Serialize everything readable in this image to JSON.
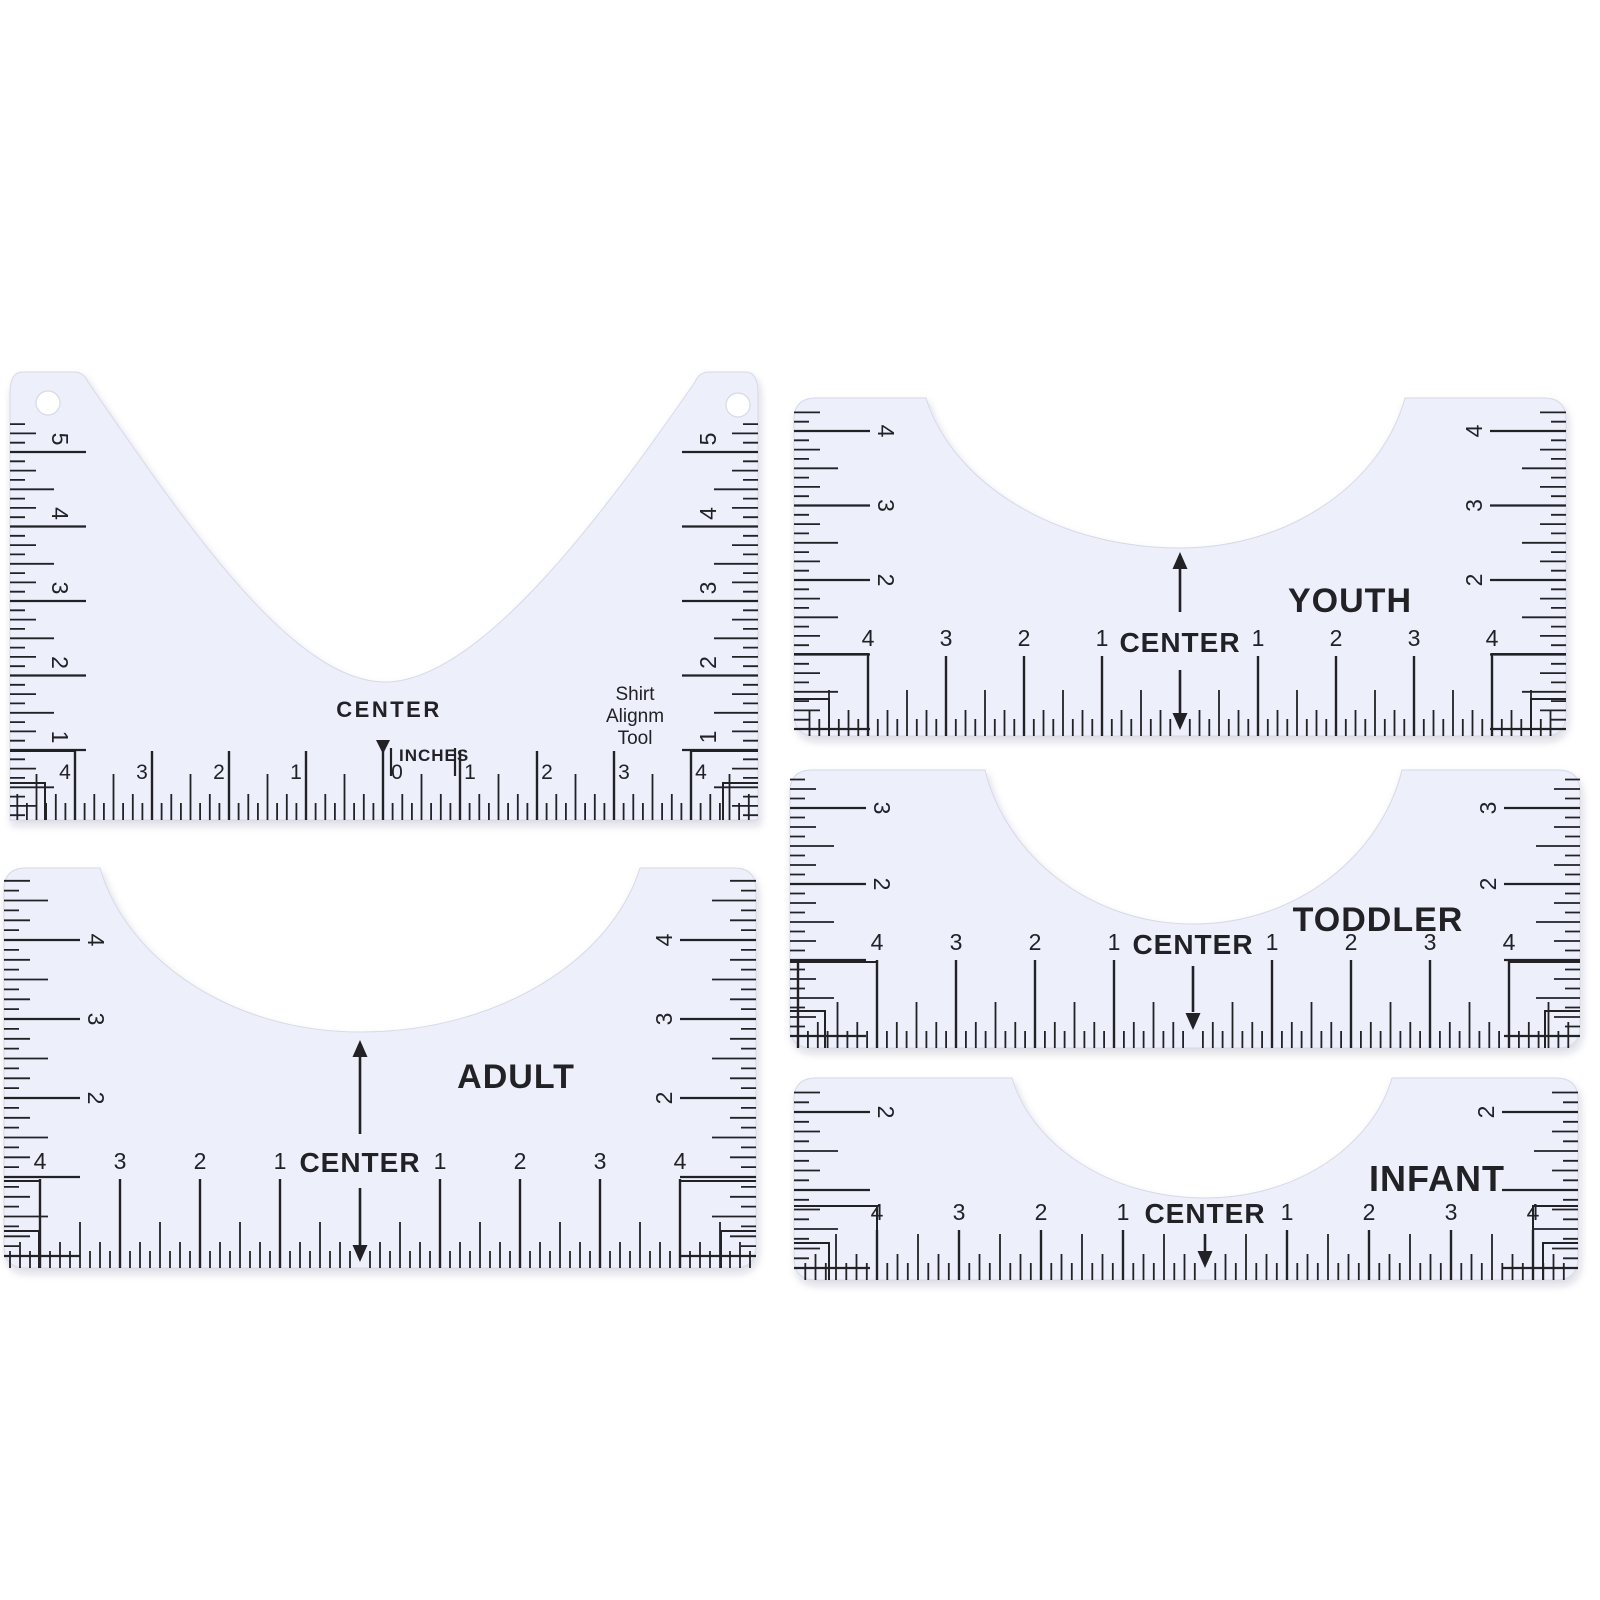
{
  "scene": {
    "width": 1600,
    "height": 1600,
    "background": "#ffffff",
    "ruler_fill": "#edeffa",
    "ruler_stroke": "#d6d9e8",
    "ink": "#212126",
    "muted_ink": "#34343a",
    "shadow_color": "#2e3252"
  },
  "rulers": [
    {
      "id": "alignment-tool",
      "texts": {
        "center": "CENTER",
        "units": "INCHES",
        "tool_lines": [
          "Shirt",
          "Alignm",
          "Tool"
        ]
      },
      "bottom": {
        "left": [
          "4",
          "3",
          "2",
          "1"
        ],
        "zero": "0",
        "right": [
          "1",
          "2",
          "3",
          "4"
        ]
      },
      "left_scale": [
        "5",
        "4",
        "3",
        "2",
        "1"
      ],
      "right_scale": [
        "5",
        "4",
        "3",
        "2",
        "1"
      ],
      "marker": "down-triangle",
      "geom": {
        "type": "big",
        "l": 10,
        "r": 758,
        "t": 372,
        "b": 820,
        "tabWL": 78,
        "tabWR": 63,
        "neck": {
          "x1": 88,
          "x2": 695,
          "cx": 385,
          "by": 682
        },
        "holes": [
          [
            48,
            403
          ],
          [
            738,
            405
          ]
        ],
        "holeR": 12,
        "centerX": 383,
        "inchH": 77,
        "numbersY": 779,
        "numFont": 21,
        "numOffset": 10,
        "wholeTop": 751,
        "btRange": [
          16,
          752
        ],
        "side": {
          "inch": 74.5,
          "ys": [
            452,
            526.5,
            601,
            675.5,
            750
          ],
          "range": [
            424,
            816
          ],
          "numInset": 50,
          "numStyle": "above"
        },
        "bracket1Y": 751,
        "textPos": {
          "center": [
            389,
            717
          ],
          "centerFont": 22,
          "units": [
            399,
            761
          ],
          "unitBars": [
            [
              391,
              748,
              776
            ],
            [
              455,
              748,
              776
            ]
          ],
          "zero": [
            397,
            779
          ],
          "marker": [
            383,
            740
          ],
          "toolX": 635,
          "toolYs": [
            700,
            722,
            744
          ],
          "toolFont": 19
        }
      }
    },
    {
      "id": "youth",
      "size_label": "YOUTH",
      "texts": {
        "center": "CENTER"
      },
      "bottom": {
        "left": [
          "4",
          "3",
          "2",
          "1"
        ],
        "zero": null,
        "right": [
          "1",
          "2",
          "3",
          "4"
        ]
      },
      "left_scale": [
        "4",
        "3",
        "2"
      ],
      "right_scale": [
        "4",
        "3",
        "2"
      ],
      "geom": {
        "type": "small",
        "l": 794,
        "r": 1566,
        "t": 398,
        "b": 736,
        "neck": {
          "x1": 926,
          "x2": 1405,
          "cx": 1180,
          "by": 548
        },
        "centerX": 1180,
        "inchH": 78,
        "numbersY": 646,
        "numFont": 23,
        "numOffset": 0,
        "wholeTop": 656,
        "btRange": [
          800,
          1560
        ],
        "side": {
          "inch": 74.5,
          "ys": [
            431,
            505.5,
            580
          ],
          "range": [
            404,
            732
          ],
          "numInset": 92,
          "numStyle": "end"
        },
        "bracket1Y": 654,
        "arrows": [
          {
            "dir": "up",
            "x": 1180,
            "y1": 566,
            "y2": 612,
            "tip": 552
          },
          {
            "dir": "down",
            "x": 1180,
            "y1": 670,
            "y2": 714,
            "tip": 730
          }
        ],
        "textPos": {
          "center": [
            1180,
            652
          ],
          "centerFont": 28,
          "label": [
            1350,
            612
          ],
          "labelFont": 34
        }
      }
    },
    {
      "id": "toddler",
      "size_label": "TODDLER",
      "texts": {
        "center": "CENTER"
      },
      "bottom": {
        "left": [
          "4",
          "3",
          "2",
          "1"
        ],
        "zero": null,
        "right": [
          "1",
          "2",
          "3",
          "4"
        ]
      },
      "left_scale": [
        "3",
        "2"
      ],
      "right_scale": [
        "3",
        "2"
      ],
      "geom": {
        "type": "small",
        "l": 790,
        "r": 1580,
        "t": 770,
        "b": 1048,
        "neck": {
          "x1": 985,
          "x2": 1402,
          "cx": 1193,
          "by": 924
        },
        "centerX": 1193,
        "inchH": 79,
        "numbersY": 950,
        "numFont": 23,
        "numOffset": 0,
        "wholeTop": 960,
        "btRange": [
          796,
          1574
        ],
        "side": {
          "inch": 76,
          "ys": [
            808,
            884
          ],
          "range": [
            776,
            1044
          ],
          "numInset": 92,
          "numStyle": "end"
        },
        "bracket1Y": 962,
        "arrows": [
          {
            "dir": "down",
            "x": 1193,
            "y1": 966,
            "y2": 1012,
            "tip": 1030
          }
        ],
        "textPos": {
          "center": [
            1193,
            954
          ],
          "centerFont": 28,
          "label": [
            1378,
            931
          ],
          "labelFont": 34
        }
      }
    },
    {
      "id": "adult",
      "size_label": "ADULT",
      "texts": {
        "center": "CENTER"
      },
      "bottom": {
        "left": [
          "4",
          "3",
          "2",
          "1"
        ],
        "zero": null,
        "right": [
          "1",
          "2",
          "3",
          "4"
        ]
      },
      "left_scale": [
        "4",
        "3",
        "2"
      ],
      "right_scale": [
        "4",
        "3",
        "2"
      ],
      "geom": {
        "type": "small",
        "l": 4,
        "r": 756,
        "t": 868,
        "b": 1268,
        "neck": {
          "x1": 100,
          "x2": 640,
          "cx": 360,
          "by": 1032
        },
        "centerX": 360,
        "inchH": 80,
        "numbersY": 1169,
        "numFont": 23,
        "numOffset": 0,
        "wholeTop": 1179,
        "btRange": [
          10,
          750
        ],
        "side": {
          "inch": 79,
          "ys": [
            940,
            1019,
            1098
          ],
          "range": [
            876,
            1264
          ],
          "numInset": 92,
          "numStyle": "end"
        },
        "bracket1Y": 1181,
        "arrows": [
          {
            "dir": "up",
            "x": 360,
            "y1": 1056,
            "y2": 1134,
            "tip": 1040
          },
          {
            "dir": "down",
            "x": 360,
            "y1": 1188,
            "y2": 1246,
            "tip": 1262
          }
        ],
        "textPos": {
          "center": [
            360,
            1172
          ],
          "centerFont": 28,
          "label": [
            516,
            1088
          ],
          "labelFont": 34
        }
      }
    },
    {
      "id": "infant",
      "size_label": "INFANT",
      "texts": {
        "center": "CENTER"
      },
      "bottom": {
        "left": [
          "4",
          "3",
          "2",
          "1"
        ],
        "zero": null,
        "right": [
          "1",
          "2",
          "3",
          "4"
        ]
      },
      "left_scale": [
        "2"
      ],
      "right_scale": [
        "2"
      ],
      "geom": {
        "type": "small",
        "l": 794,
        "r": 1578,
        "t": 1078,
        "b": 1280,
        "neck": {
          "x1": 1012,
          "x2": 1392,
          "cx": 1205,
          "by": 1198
        },
        "centerX": 1205,
        "inchH": 82,
        "numbersY": 1220,
        "numFont": 23,
        "numOffset": 0,
        "wholeTop": 1230,
        "btRange": [
          800,
          1572
        ],
        "side": {
          "inch": 78,
          "ys": [
            1112
          ],
          "range": [
            1084,
            1276
          ],
          "numInset": 92,
          "numStyle": "end"
        },
        "bracket1Y": 1206,
        "arrows": [
          {
            "dir": "down",
            "x": 1205,
            "y1": 1234,
            "y2": 1252,
            "tip": 1268
          }
        ],
        "textPos": {
          "center": [
            1205,
            1223
          ],
          "centerFont": 28,
          "label": [
            1437,
            1191
          ],
          "labelFont": 36
        }
      }
    }
  ]
}
